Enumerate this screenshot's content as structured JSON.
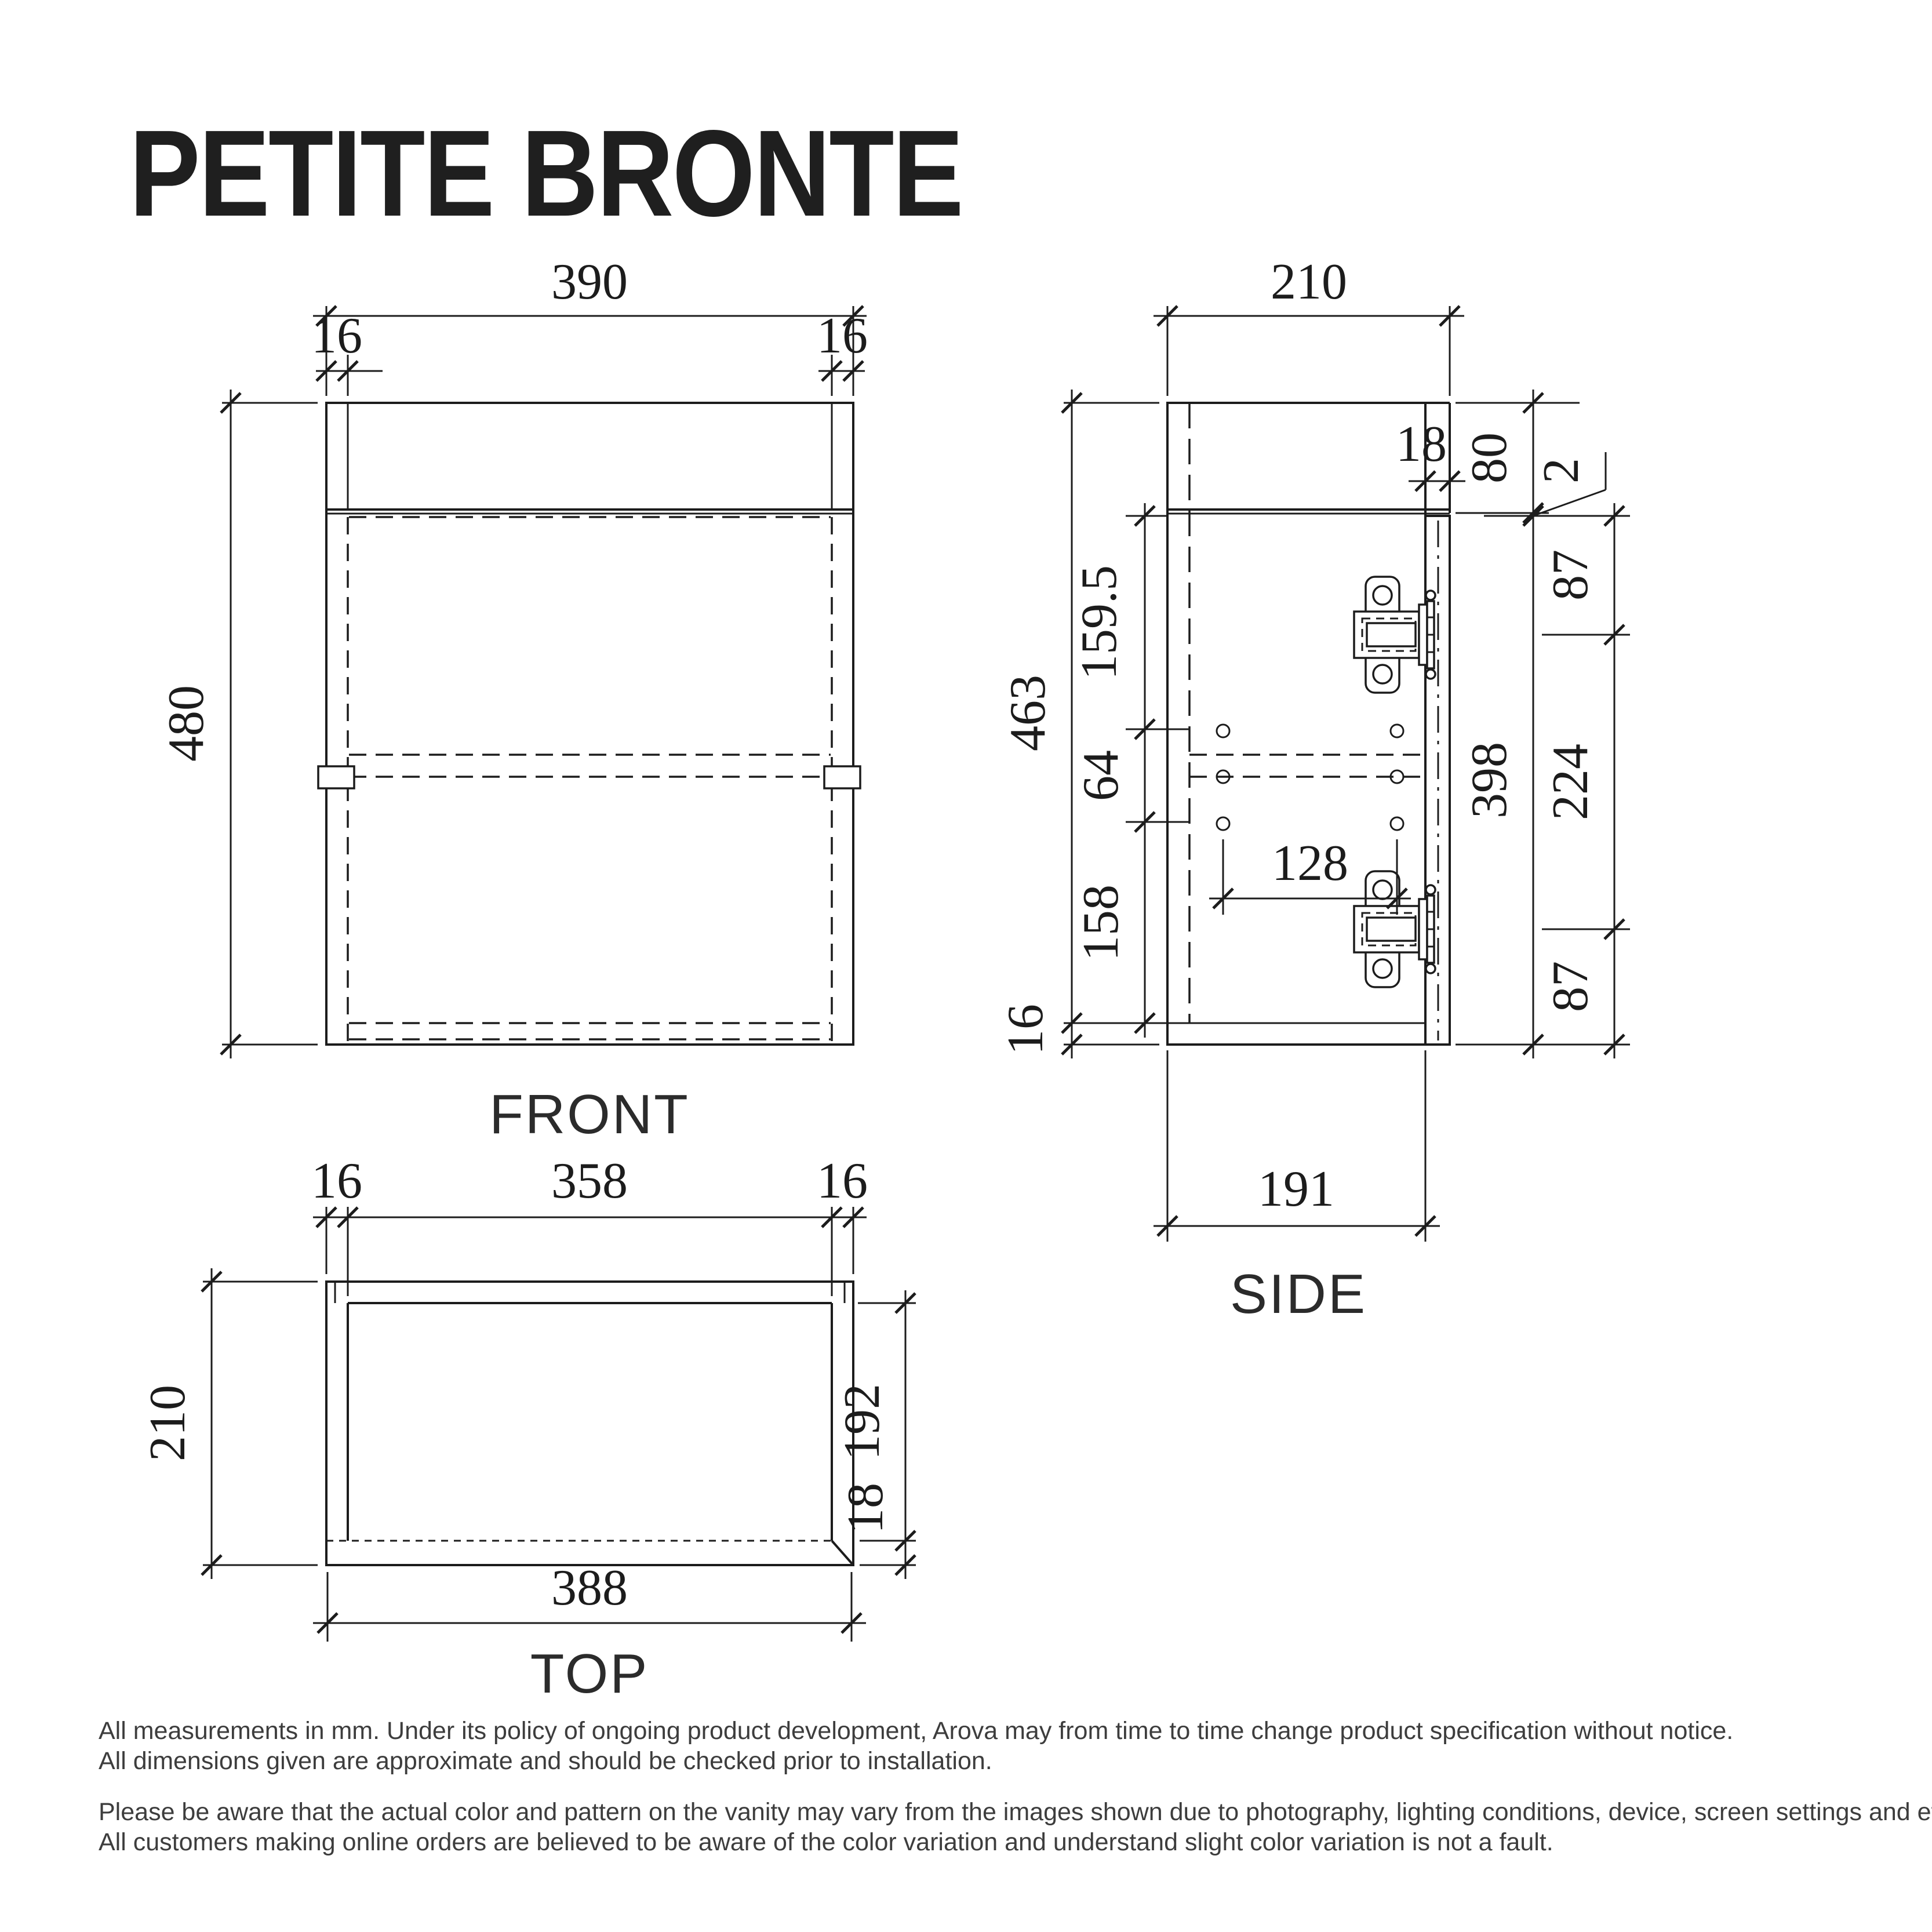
{
  "title": "PETITE BRONTE",
  "front": {
    "label": "FRONT",
    "width": "390",
    "wall_left": "16",
    "wall_right": "16",
    "height": "480"
  },
  "side": {
    "label": "SIDE",
    "depth": "210",
    "door": "18",
    "rail": "80",
    "gap": "2",
    "h_top": "87",
    "h_mid": "224",
    "h_bot": "87",
    "door_h": "398",
    "carcass": "463",
    "s1": "159.5",
    "s2": "64",
    "s3": "158",
    "s4": "16",
    "holes": "128",
    "body": "191"
  },
  "top": {
    "label": "TOP",
    "wall_left": "16",
    "inner": "358",
    "wall_right": "16",
    "depth": "210",
    "inner_depth": "192",
    "panel": "18",
    "overall": "388"
  },
  "notes": {
    "l1": "All measurements in mm. Under its policy of ongoing product development, Arova may from time to time change product specification without notice.",
    "l2": "All dimensions given are approximate and should be checked prior to installation.",
    "l3": "Please be aware that the actual color and pattern on the vanity may vary from the images shown due to photography, lighting conditions, device, screen settings and etc.",
    "l4": "All customers making online orders are believed to be aware of the color variation and understand slight color variation is not a fault."
  }
}
